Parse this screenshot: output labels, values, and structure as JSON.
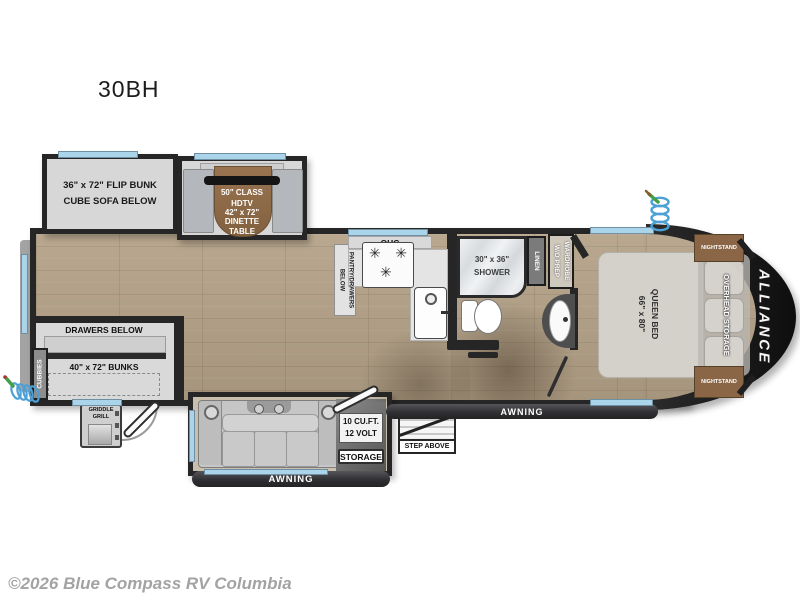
{
  "page": {
    "title": "30BH",
    "copyright": "©2026 Blue Compass RV Columbia"
  },
  "brand": {
    "name": "ALLIANCE"
  },
  "living": {
    "flip_bunk": "36\" x 72\" FLIP BUNK\nCUBE SOFA BELOW",
    "dinette_ohc": "OHC",
    "tv": "50\" CLASS\nHDTV",
    "dinette_table": "42\" x 72\"\nDINETTE\nTABLE"
  },
  "kitchen": {
    "ohc": "OHC",
    "pantry": "PANTRY/DRAWERS\nBELOW",
    "fridge": "10 CU.FT.\n12 VOLT"
  },
  "bath": {
    "shower": "30\" x 36\"\nSHOWER",
    "linen": "LINEN",
    "wardrobe": "WARDROBE\nW/D PREP"
  },
  "bedroom": {
    "bed": "QUEEN BED\n66\" x 80\"",
    "overhead": "OVERHEAD STORAGE",
    "nightstand_top": "NIGHTSTAND",
    "nightstand_bottom": "NIGHTSTAND"
  },
  "bunkroom": {
    "drawers_below": "DRAWERS BELOW",
    "bunks": "40\" x 72\" BUNKS",
    "cubbies": "CUBBIES"
  },
  "exterior": {
    "griddle": "GRIDDLE\nGRILL",
    "awning_left": "AWNING",
    "awning_right": "AWNING",
    "step_above": "STEP ABOVE",
    "storage": "STORAGE"
  },
  "icons": {
    "burner": "✳"
  },
  "colors": {
    "window_blue": "#a9d4e9",
    "wall": "#262626",
    "wood": "#b1a089",
    "accent_brown": "#8a6647"
  }
}
